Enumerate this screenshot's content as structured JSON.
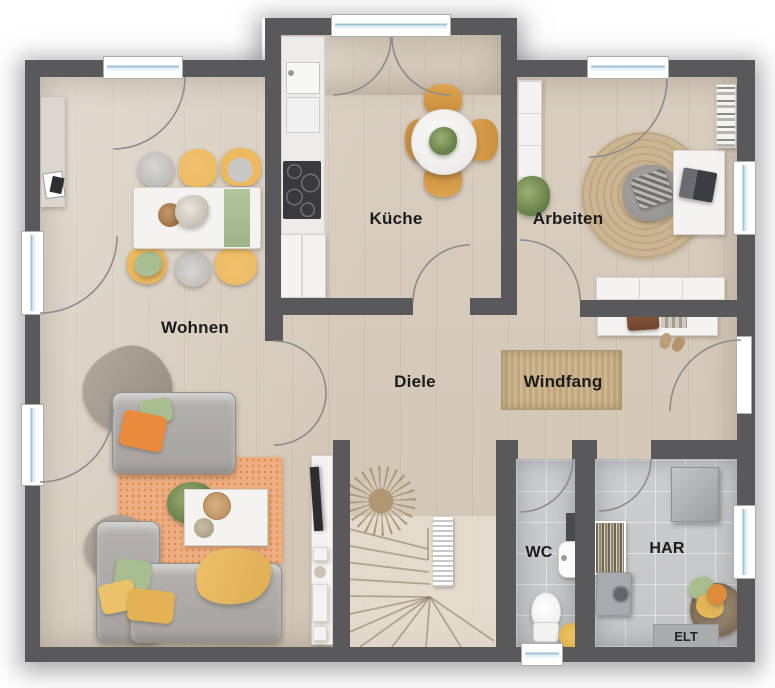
{
  "plan": {
    "type": "residential-floor-plan",
    "floor_labels": {
      "wohnen": "Wohnen",
      "kueche": "Küche",
      "arbeiten": "Arbeiten",
      "diele": "Diele",
      "windfang": "Windfang",
      "wc": "WC",
      "har": "HAR",
      "elt": "ELT"
    },
    "colors": {
      "wall": "#59585b",
      "wood_floor": "#d8cdbf",
      "tile_floor": "#c3c4c6",
      "stair_wood": "#e9e1d3",
      "window_glass": "#9ec2d6",
      "door_arc": "#8d8c8a",
      "accent_orange": "#e98a3d",
      "accent_yellow": "#ecb95e",
      "accent_green": "#a8bd90",
      "rug_orange": "#eeae81",
      "rug_jute": "#cbb492",
      "sofa_gray": "#a5a29f",
      "furniture_white": "#f4f3f1",
      "label_text": "#1b1b1b"
    },
    "furniture_icons": {
      "wohnen": [
        "dining-table",
        "dining-chairs",
        "sideboard",
        "sofa",
        "sofa-chaise",
        "coffee-table",
        "orange-rug",
        "tv-lowboard"
      ],
      "kueche": [
        "kitchen-counter",
        "sink",
        "cooktop",
        "base-cabinet",
        "round-table",
        "wood-chairs"
      ],
      "arbeiten": [
        "wardrobe",
        "jute-rug",
        "armchair",
        "desk",
        "laptop",
        "bookshelf",
        "sideboard"
      ],
      "diele": [
        "hall-shelf",
        "shoes",
        "stairs",
        "radiator",
        "dried-plant",
        "door-mat"
      ],
      "wc": [
        "hand-sink",
        "toilet",
        "towel"
      ],
      "har": [
        "boiler",
        "drying-rack",
        "washing-machine",
        "laundry-basket",
        "elt-cabinet"
      ]
    }
  }
}
